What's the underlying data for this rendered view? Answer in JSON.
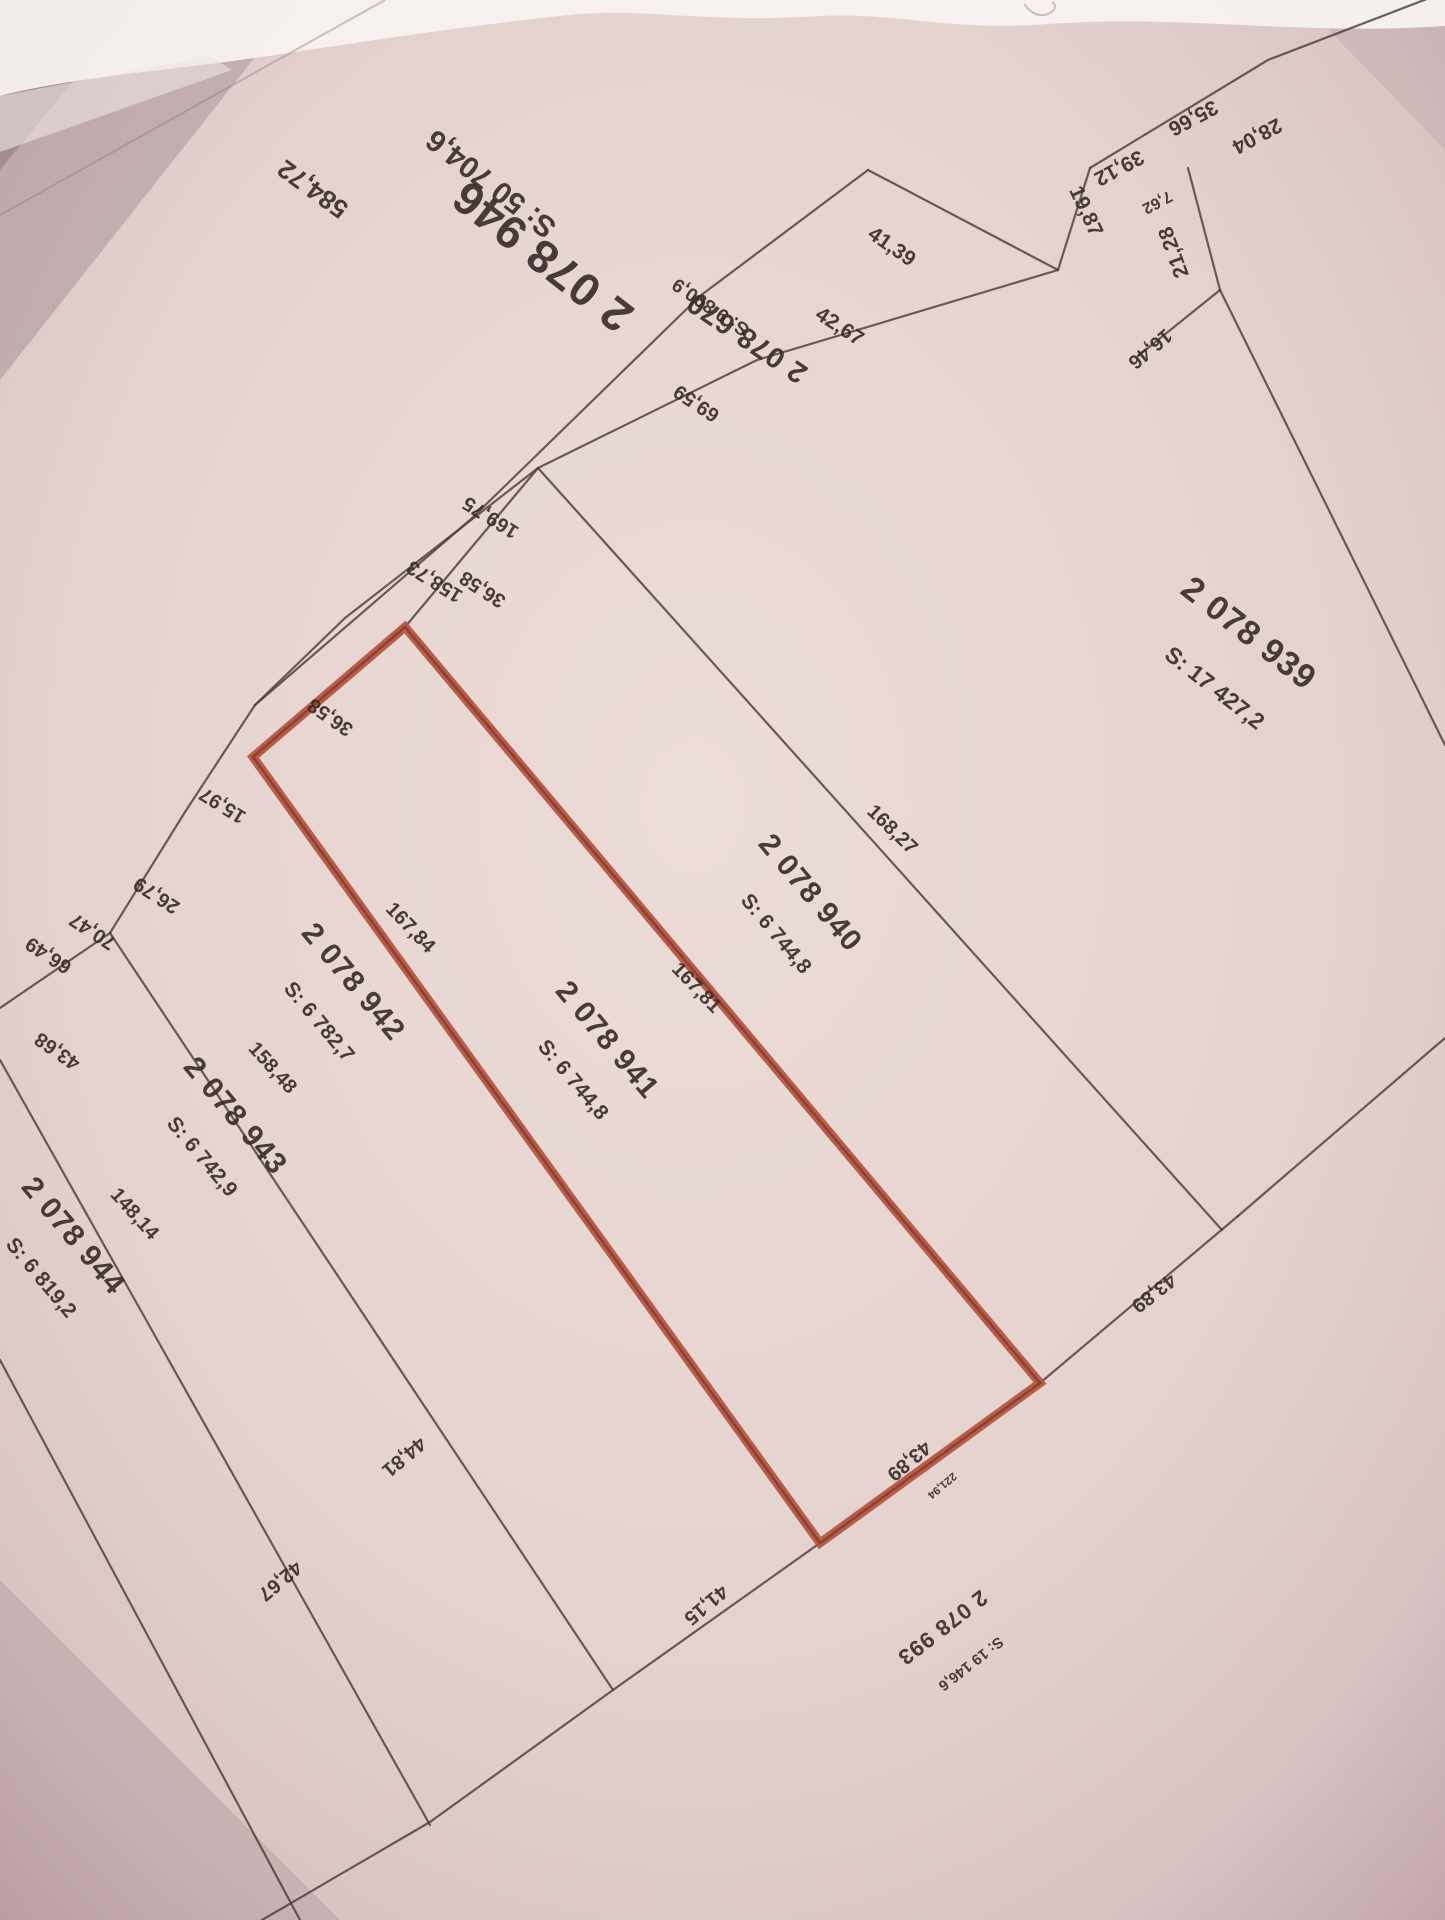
{
  "map": {
    "kind": "cadastral-plan-photo",
    "highlighted_parcel": "2 078 941",
    "colors": {
      "paper": "#e7d5d1",
      "paper_edge": "#bfa1a8",
      "line": "#4c3d3a",
      "text": "#392d2a",
      "highlight": "#b2543e",
      "highlight_core": "#8e3a29",
      "pen_mark": "#44519e"
    }
  },
  "parcels": [
    {
      "number": "2 078 946",
      "area": "S: 50 704,6",
      "num": {
        "x": 552,
        "y": 244,
        "rot": 218,
        "size": 46
      },
      "areal": {
        "x": 497,
        "y": 176,
        "rot": 218,
        "size": 30
      }
    },
    {
      "number": "2 078 670",
      "area": "S: 9 890,9",
      "num": {
        "x": 752,
        "y": 330,
        "rot": 214,
        "size": 29
      },
      "areal": {
        "x": 714,
        "y": 302,
        "rot": 214,
        "size": 19
      }
    },
    {
      "number": "2 078 939",
      "area": "S: 17 427,2",
      "num": {
        "x": 1242,
        "y": 642,
        "rot": 38,
        "size": 34
      },
      "areal": {
        "x": 1210,
        "y": 694,
        "rot": 38,
        "size": 23
      }
    },
    {
      "number": "2 078 940",
      "area": "S: 6 744,8",
      "num": {
        "x": 803,
        "y": 899,
        "rot": 50,
        "size": 30
      },
      "areal": {
        "x": 771,
        "y": 938,
        "rot": 50,
        "size": 21
      }
    },
    {
      "number": "2 078 941",
      "area": "S: 6 744,8",
      "num": {
        "x": 600,
        "y": 1046,
        "rot": 50,
        "size": 30
      },
      "areal": {
        "x": 568,
        "y": 1084,
        "rot": 50,
        "size": 21
      }
    },
    {
      "number": "2 078 942",
      "area": "S: 6 782,7",
      "num": {
        "x": 346,
        "y": 988,
        "rot": 50,
        "size": 30
      },
      "areal": {
        "x": 314,
        "y": 1026,
        "rot": 50,
        "size": 21
      }
    },
    {
      "number": "2 078 943",
      "area": "S: 6 742,9",
      "num": {
        "x": 228,
        "y": 1122,
        "rot": 50,
        "size": 30
      },
      "areal": {
        "x": 197,
        "y": 1161,
        "rot": 50,
        "size": 21
      }
    },
    {
      "number": "2 078 944",
      "area": "S: 6 819,2",
      "num": {
        "x": 66,
        "y": 1242,
        "rot": 50,
        "size": 30
      },
      "areal": {
        "x": 36,
        "y": 1282,
        "rot": 50,
        "size": 21
      }
    },
    {
      "number": "2 078 993",
      "area": "S: 19 146,6",
      "num": {
        "x": 938,
        "y": 1622,
        "rot": 142,
        "size": 22
      },
      "areal": {
        "x": 968,
        "y": 1660,
        "rot": 142,
        "size": 15
      }
    }
  ],
  "measurements": [
    {
      "v": "584,72",
      "x": 318,
      "y": 182,
      "rot": 216,
      "size": 26
    },
    {
      "v": "69,59",
      "x": 700,
      "y": 398,
      "rot": 214,
      "size": 20
    },
    {
      "v": "169,75",
      "x": 494,
      "y": 512,
      "rot": 212,
      "size": 20
    },
    {
      "v": "158,73",
      "x": 438,
      "y": 576,
      "rot": 212,
      "size": 20
    },
    {
      "v": "36,58",
      "x": 486,
      "y": 584,
      "rot": 213,
      "size": 20
    },
    {
      "v": "36,58",
      "x": 334,
      "y": 712,
      "rot": 215,
      "size": 20
    },
    {
      "v": "15,97",
      "x": 226,
      "y": 800,
      "rot": 212,
      "size": 20
    },
    {
      "v": "26,79",
      "x": 160,
      "y": 890,
      "rot": 213,
      "size": 20
    },
    {
      "v": "70,47",
      "x": 96,
      "y": 926,
      "rot": 213,
      "size": 20
    },
    {
      "v": "66,49",
      "x": 52,
      "y": 950,
      "rot": 213,
      "size": 20
    },
    {
      "v": "43,68",
      "x": 61,
      "y": 1046,
      "rot": 215,
      "size": 20
    },
    {
      "v": "41,39",
      "x": 888,
      "y": 252,
      "rot": 35,
      "size": 21
    },
    {
      "v": "42,67",
      "x": 836,
      "y": 332,
      "rot": 33,
      "size": 21
    },
    {
      "v": "19,87",
      "x": 1080,
      "y": 214,
      "rot": 65,
      "size": 21
    },
    {
      "v": "39,12",
      "x": 1116,
      "y": 162,
      "rot": 152,
      "size": 21
    },
    {
      "v": "35,66",
      "x": 1190,
      "y": 112,
      "rot": 152,
      "size": 21
    },
    {
      "v": "28,04",
      "x": 1254,
      "y": 130,
      "rot": 152,
      "size": 21
    },
    {
      "v": "7,62",
      "x": 1155,
      "y": 198,
      "rot": 152,
      "size": 16
    },
    {
      "v": "21,28",
      "x": 1180,
      "y": 250,
      "rot": 250,
      "size": 21
    },
    {
      "v": "16,46",
      "x": 1146,
      "y": 344,
      "rot": 140,
      "size": 20
    },
    {
      "v": "168,27",
      "x": 888,
      "y": 834,
      "rot": 44,
      "size": 20
    },
    {
      "v": "167,81",
      "x": 692,
      "y": 992,
      "rot": 46,
      "size": 20
    },
    {
      "v": "167,84",
      "x": 406,
      "y": 932,
      "rot": 46,
      "size": 20
    },
    {
      "v": "158,48",
      "x": 268,
      "y": 1072,
      "rot": 48,
      "size": 20
    },
    {
      "v": "148,14",
      "x": 130,
      "y": 1218,
      "rot": 48,
      "size": 20
    },
    {
      "v": "43,89",
      "x": 1150,
      "y": 1288,
      "rot": 142,
      "size": 20
    },
    {
      "v": "43,89",
      "x": 905,
      "y": 1456,
      "rot": 140,
      "size": 20
    },
    {
      "v": "221,94",
      "x": 940,
      "y": 1483,
      "rot": 140,
      "size": 11
    },
    {
      "v": "41,15",
      "x": 702,
      "y": 1600,
      "rot": 140,
      "size": 20
    },
    {
      "v": "44,81",
      "x": 400,
      "y": 1452,
      "rot": 140,
      "size": 20
    },
    {
      "v": "42,67",
      "x": 276,
      "y": 1576,
      "rot": 140,
      "size": 20
    }
  ]
}
